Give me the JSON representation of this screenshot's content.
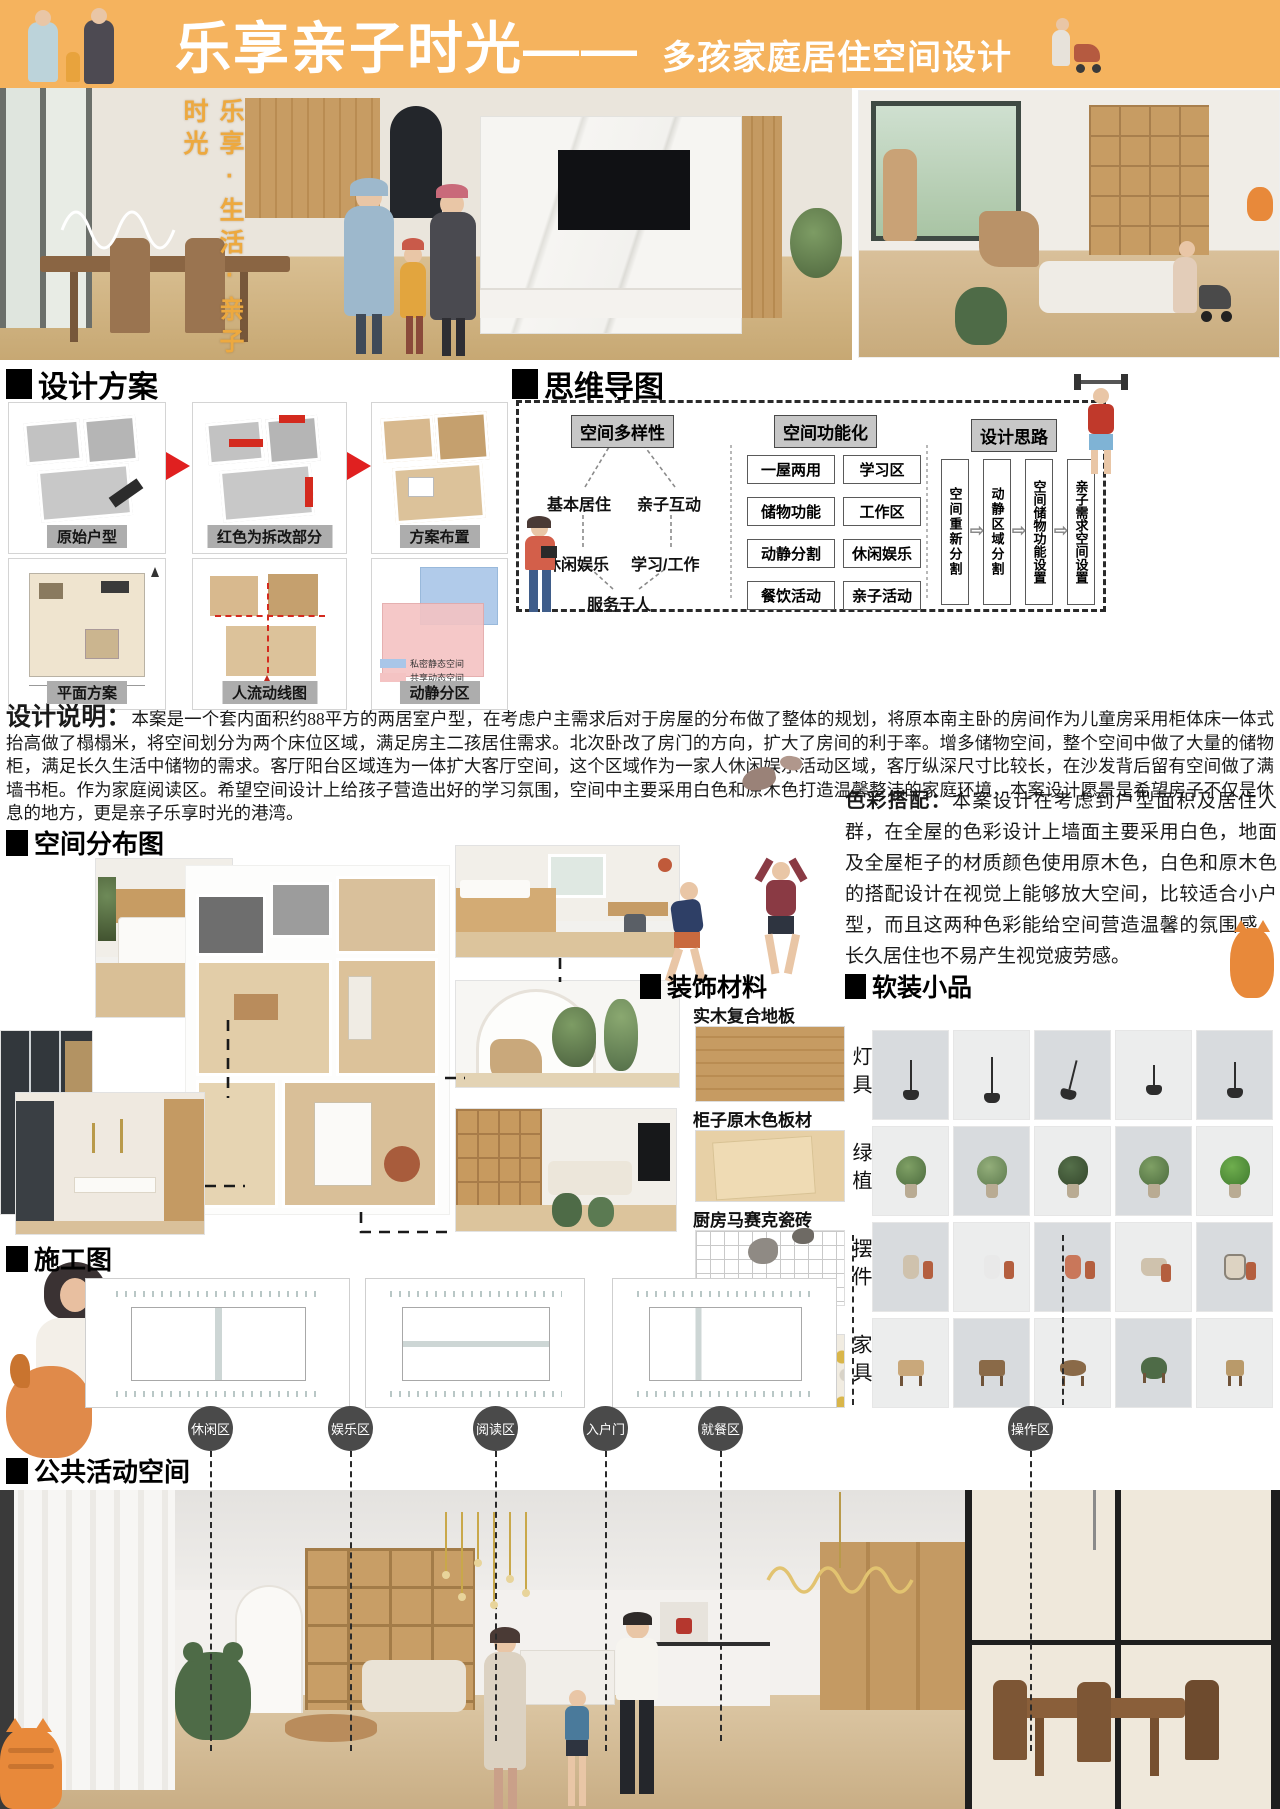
{
  "header": {
    "title_main": "乐享亲子时光——",
    "title_sub": "多孩家庭居住空间设计"
  },
  "hero": {
    "vertical_slogan": "乐享·生活·亲子时光"
  },
  "sections": {
    "design_scheme": "设计方案",
    "mind_map": "思维导图",
    "space_distribution": "空间分布图",
    "construction": "施工图",
    "materials": "装饰材料",
    "soft_furnishing": "软装小品",
    "public_space": "公共活动空间"
  },
  "design_scheme": {
    "plans": [
      {
        "label": "原始户型"
      },
      {
        "label": "红色为拆改部分"
      },
      {
        "label": "方案布置"
      },
      {
        "label": "平面方案"
      },
      {
        "label": "人流动线图"
      },
      {
        "label": "动静分区"
      }
    ],
    "legend": [
      {
        "label": "私密静态空间",
        "color": "#a9c6e8"
      },
      {
        "label": "共享动态空间",
        "color": "#f4c3c3"
      }
    ]
  },
  "mind_map": {
    "node_diversity": "空间多样性",
    "node_functional": "空间功能化",
    "node_approach": "设计思路",
    "diversity_items": [
      "基本居住",
      "亲子互动",
      "休闲娱乐",
      "学习/工作",
      "服务于人"
    ],
    "functional_left": [
      "一屋两用",
      "储物功能",
      "动静分割",
      "餐饮活动"
    ],
    "functional_right": [
      "学习区",
      "工作区",
      "休闲娱乐",
      "亲子活动"
    ],
    "approach_steps": [
      "空间重新分割",
      "动静区域分割",
      "空间储物功能设置",
      "亲子需求空间设置"
    ]
  },
  "design_note": {
    "label": "设计说明：",
    "body": "本案是一个套内面积约88平方的两居室户型，在考虑户主需求后对于房屋的分布做了整体的规划，将原本南主卧的房间作为儿童房采用柜体床一体式抬高做了榻榻米，将空间划分为两个床位区域，满足房主二孩居住需求。北次卧改了房门的方向，扩大了房间的利于率。增多储物空间，整个空间中做了大量的储物柜，满足长久生活中储物的需求。客厅阳台区域连为一体扩大客厅空间，这个区域作为一家人休闲娱乐活动区域，客厅纵深尺寸比较长，在沙发背后留有空间做了满墙书柜。作为家庭阅读区。希望空间设计上给孩子营造出好的学习氛围，空间中主要采用白色和原木色打造温馨整洁的家庭环境，本案设计愿景是希望房子不仅是休息的地方，更是亲子乐享时光的港湾。"
  },
  "color_note": {
    "label": "色彩搭配：",
    "body": "本案设计在考虑到户型面积及居住人群，在全屋的色彩设计上墙面主要采用白色，地面及全屋柜子的材质颜色使用原木色，白色和原木色的搭配设计在视觉上能够放大空间，比较适合小户型，而且这两种色彩能给空间营造温馨的氛围感，长久居住也不易产生视觉疲劳感。"
  },
  "materials": {
    "items": [
      "实木复合地板",
      "柜子原木色板材",
      "厨房马赛克瓷砖",
      "卫生间墙砖"
    ]
  },
  "soft_furnishing": {
    "rows": [
      "灯具",
      "绿植",
      "摆件",
      "家具"
    ]
  },
  "zones": [
    "休闲区",
    "娱乐区",
    "阅读区",
    "入户门",
    "就餐区",
    "操作区"
  ],
  "colors": {
    "header_orange": "#f5b35e",
    "accent_red": "#e02020",
    "zone_gray": "#4a4a4a",
    "wood": "#c89e66",
    "legend_blue": "#a9c6e8",
    "legend_pink": "#f4c3c3"
  }
}
